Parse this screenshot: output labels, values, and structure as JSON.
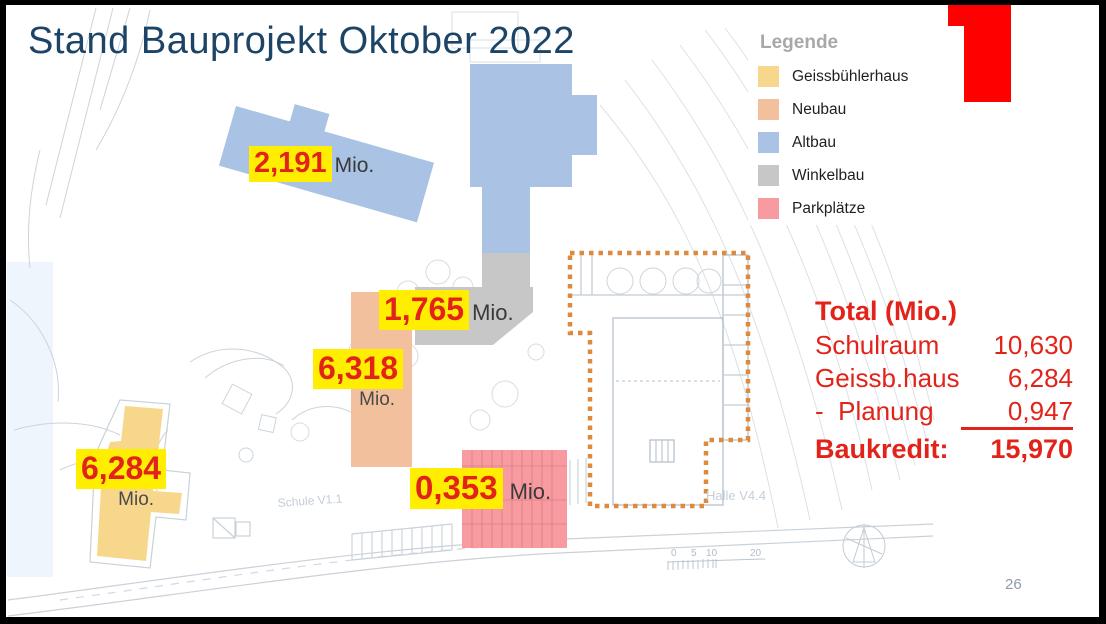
{
  "slide": {
    "title": "Stand Bauprojekt Oktober 2022",
    "page_number": "26"
  },
  "colors": {
    "title_blue": "#1c4467",
    "text_red": "#e2231a",
    "highlight_yellow": "#ffee00",
    "accent_rect_red": "#fe0000"
  },
  "legend": {
    "title": "Legende",
    "items": [
      {
        "label": "Geissbühlerhaus",
        "color": "#f7d78c"
      },
      {
        "label": "Neubau",
        "color": "#f2c09c"
      },
      {
        "label": "Altbau",
        "color": "#aac2e3"
      },
      {
        "label": "Winkelbau",
        "color": "#c7c7c7"
      },
      {
        "label": "Parkplätze",
        "color": "#f79ba0"
      }
    ]
  },
  "cost_labels": [
    {
      "building": "Altbau",
      "value": "2,191",
      "unit": "Mio."
    },
    {
      "building": "Winkelbau",
      "value": "1,765",
      "unit": "Mio."
    },
    {
      "building": "Neubau",
      "value": "6,318",
      "unit": "Mio."
    },
    {
      "building": "Geissbühlerhaus",
      "value": "6,284",
      "unit": "Mio."
    },
    {
      "building": "Parkplätze",
      "value": "0,353",
      "unit": "Mio."
    }
  ],
  "totals": {
    "title": "Total (Mio.)",
    "rows": [
      {
        "label": "Schulraum",
        "value": "10,630"
      },
      {
        "label": "Geissb.haus",
        "value": "6,284"
      },
      {
        "label": "-  Planung",
        "value": "0,947"
      },
      {
        "label": "Baukredit:",
        "value": "15,970"
      }
    ]
  },
  "map": {
    "schule_label": "Schule V1.1",
    "halle_label": "Halle V4.4",
    "scale_ticks": [
      "0",
      "5",
      "10",
      "20"
    ]
  }
}
